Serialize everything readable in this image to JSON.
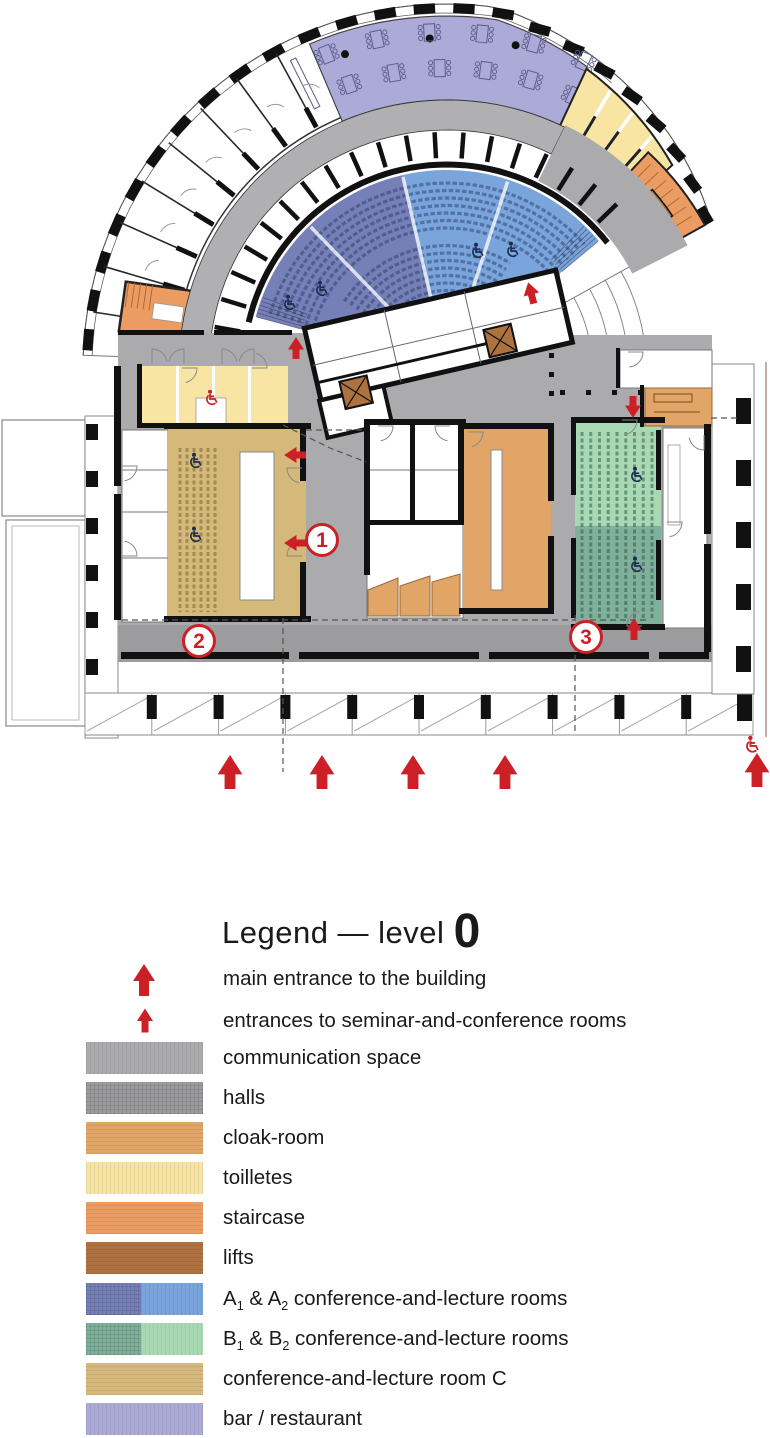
{
  "plan": {
    "colors": {
      "communication": "#ABABAD",
      "halls": "#9C9C9E",
      "cloakroom": "#E0A567",
      "toilets": "#F8E5A3",
      "staircase": "#EA9C62",
      "lifts": "#AE7240",
      "room_a1": "#7680B8",
      "room_a2": "#79A5DC",
      "room_b1": "#7FB09B",
      "room_b2": "#A8D8B4",
      "room_c": "#D5B97B",
      "bar_restaurant": "#ACABD7",
      "accent_red": "#CC2027",
      "wheelchair_navy": "#1D2B50",
      "walls": "#111111"
    },
    "annotations": {
      "numbers": [
        "1",
        "2",
        "3"
      ]
    }
  },
  "legend": {
    "title_main": "Legend — level",
    "title_level": "0",
    "entries": [
      {
        "type": "icon",
        "icon": "main-entrance-arrow",
        "label": "main entrance to the building"
      },
      {
        "type": "icon",
        "icon": "seminar-entrance-arrow",
        "label": "entrances to seminar-and-conference rooms"
      },
      {
        "type": "swatch",
        "key": "communication",
        "label": "communication space"
      },
      {
        "type": "swatch",
        "key": "halls",
        "label": "halls"
      },
      {
        "type": "swatch",
        "key": "cloakroom",
        "label": "cloak-room"
      },
      {
        "type": "swatch",
        "key": "toilets",
        "label": "toilletes"
      },
      {
        "type": "swatch",
        "key": "staircase",
        "label": "staircase"
      },
      {
        "type": "swatch",
        "key": "lifts",
        "label": "lifts"
      },
      {
        "type": "swatch2",
        "keys": [
          "room_a1",
          "room_a2"
        ],
        "parts": [
          "A",
          "1",
          " & A",
          "2",
          " conference-and-lecture rooms"
        ]
      },
      {
        "type": "swatch2",
        "keys": [
          "room_b1",
          "room_b2"
        ],
        "parts": [
          "B",
          "1",
          " & B",
          "2",
          " conference-and-lecture rooms"
        ]
      },
      {
        "type": "swatch",
        "key": "room_c",
        "label": "conference-and-lecture room C"
      },
      {
        "type": "swatch",
        "key": "bar_restaurant",
        "label": "bar / restaurant"
      }
    ]
  }
}
